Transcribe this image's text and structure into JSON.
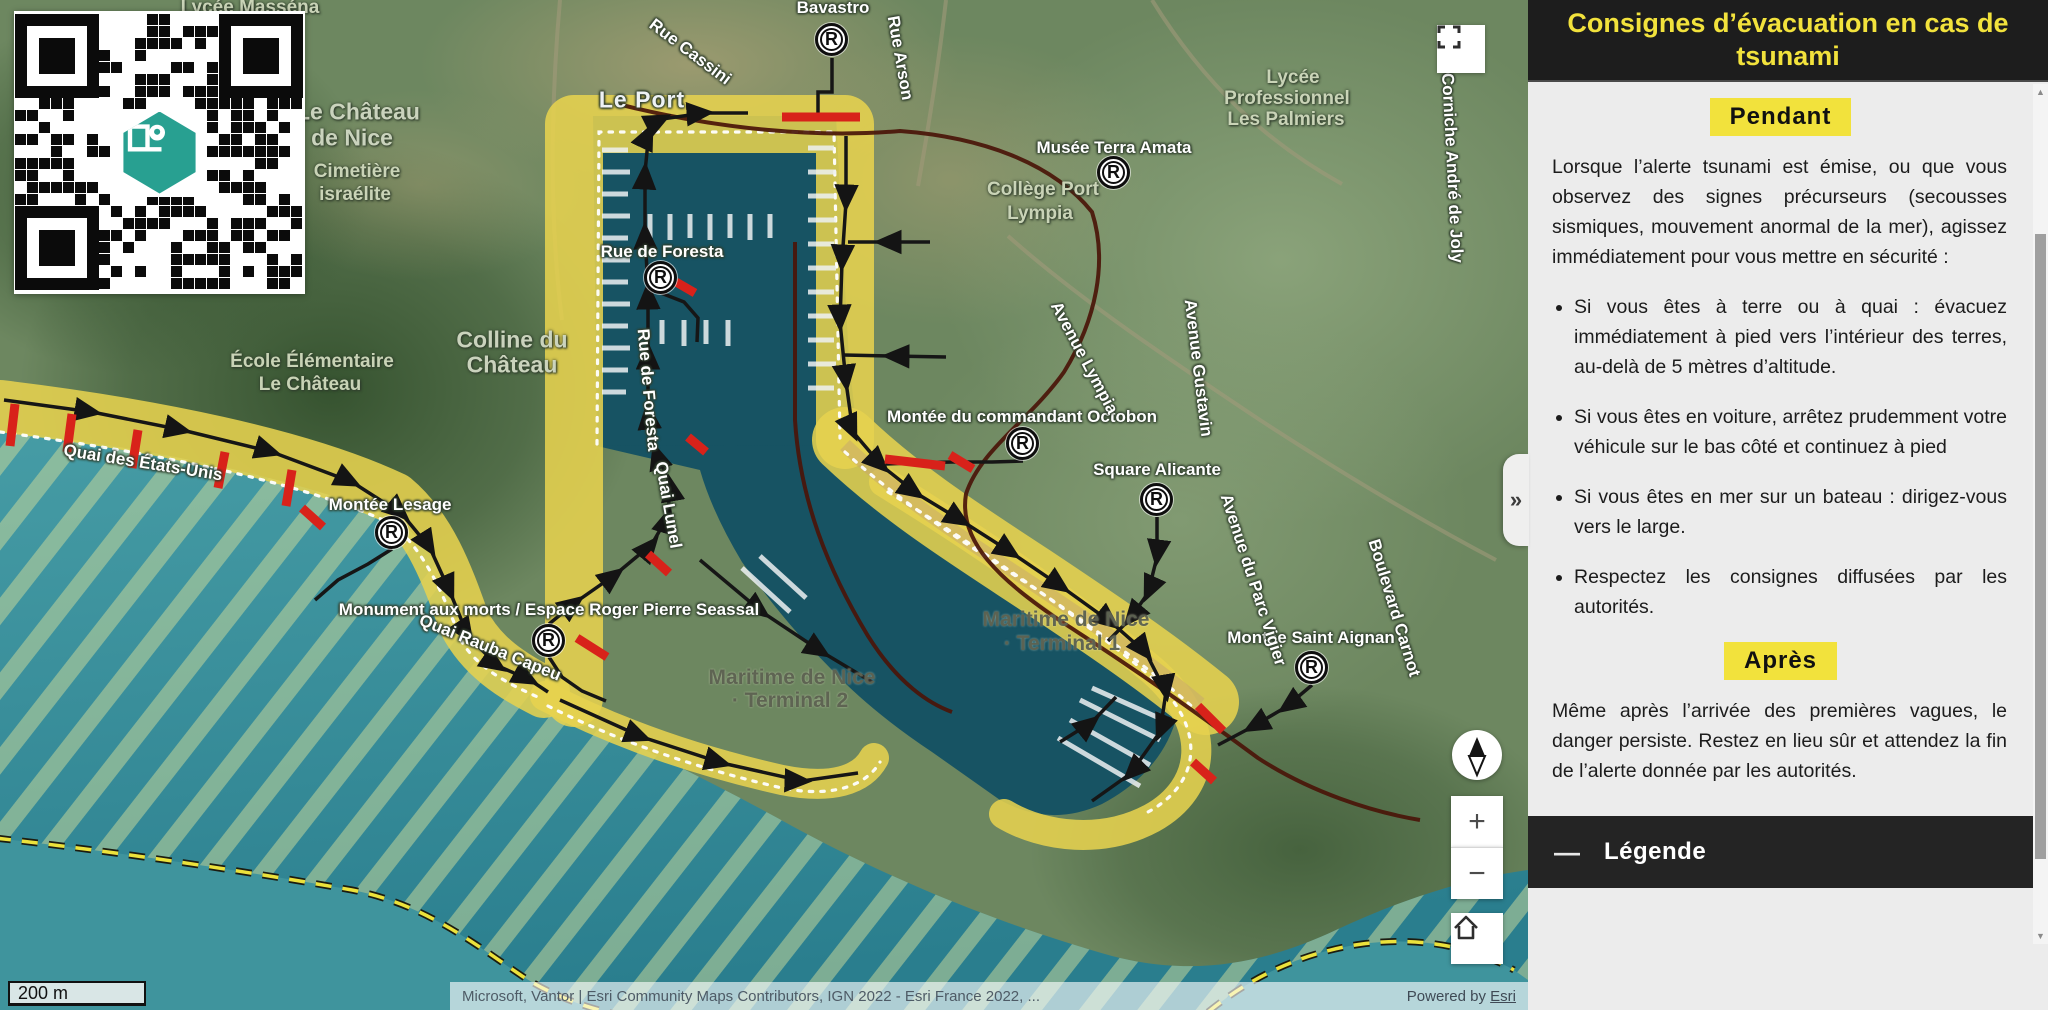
{
  "sidebar": {
    "title": "Consignes d’évacuation en cas de tsunami",
    "collapse_glyph": "»",
    "pendant": {
      "badge": "Pendant",
      "intro": "Lorsque l’alerte tsunami est émise, ou que vous observez des signes précurseurs (secousses sismiques, mouvement anormal de la mer), agissez immédiatement pour vous mettre en sécurité :",
      "bullets": [
        "Si vous êtes à terre ou à quai : évacuez immédiatement à pied vers l’intérieur des terres, au-delà de 5 mètres d’altitude.",
        "Si vous êtes en voiture, arrêtez prudemment votre véhicule sur le bas côté et continuez à pied",
        "Si vous êtes en mer sur un bateau : dirigez-vous vers le large.",
        "Respectez les consignes diffusées par les autorités."
      ]
    },
    "apres": {
      "badge": "Après",
      "text": "Même après l’arrivée des premières vagues, le danger persiste. Restez en lieu sûr et attendez la fin de l’alerte donnée par les autorités."
    },
    "legend": {
      "label": "Légende",
      "collapse_glyph": "—"
    }
  },
  "controls": {
    "zoom_in": "+",
    "zoom_out": "−",
    "fullscreen_icon": "fullscreen",
    "compass_icon": "compass-north",
    "home_icon": "home"
  },
  "map": {
    "scale_label": "200 m",
    "attribution": {
      "sources": "Microsoft, Vantor | Esri Community Maps Contributors, IGN 2022 - Esri France 2022, ...",
      "powered_by": "Powered by",
      "powered_by_link": "Esri"
    },
    "refuge_glyph": "R",
    "refuge_points": [
      {
        "x": 832,
        "y": 40
      },
      {
        "x": 661,
        "y": 278
      },
      {
        "x": 1114,
        "y": 173
      },
      {
        "x": 392,
        "y": 533
      },
      {
        "x": 549,
        "y": 641
      },
      {
        "x": 1023,
        "y": 444
      },
      {
        "x": 1157,
        "y": 500
      },
      {
        "x": 1312,
        "y": 668
      }
    ],
    "labels": [
      {
        "text": "Lycée Masséna",
        "x": 250,
        "y": 8,
        "rot": 0,
        "cls": "poi"
      },
      {
        "text": "Bavastro",
        "x": 833,
        "y": 8,
        "rot": 0,
        "cls": ""
      },
      {
        "text": "Rue Cassini",
        "x": 690,
        "y": 52,
        "rot": 37,
        "cls": ""
      },
      {
        "text": "Rue Arson",
        "x": 900,
        "y": 58,
        "rot": 80,
        "cls": ""
      },
      {
        "text": "Le Port",
        "x": 642,
        "y": 100,
        "rot": 0,
        "cls": "st-lg"
      },
      {
        "text": "Le Château",
        "x": 358,
        "y": 112,
        "rot": 0,
        "cls": "poi-l"
      },
      {
        "text": "de Nice",
        "x": 352,
        "y": 138,
        "rot": 0,
        "cls": "poi-l"
      },
      {
        "text": "Cimetière",
        "x": 357,
        "y": 172,
        "rot": 0,
        "cls": "poi"
      },
      {
        "text": "israélite",
        "x": 355,
        "y": 195,
        "rot": 0,
        "cls": "poi"
      },
      {
        "text": "Musée Terra Amata",
        "x": 1114,
        "y": 148,
        "rot": 0,
        "cls": ""
      },
      {
        "text": "Collège Port",
        "x": 1043,
        "y": 190,
        "rot": 0,
        "cls": "poi"
      },
      {
        "text": "Lympia",
        "x": 1040,
        "y": 214,
        "rot": 0,
        "cls": "poi"
      },
      {
        "text": "Lycée",
        "x": 1293,
        "y": 78,
        "rot": 0,
        "cls": "poi"
      },
      {
        "text": "Professionnel",
        "x": 1287,
        "y": 99,
        "rot": 0,
        "cls": "poi"
      },
      {
        "text": "Les Palmiers",
        "x": 1286,
        "y": 120,
        "rot": 0,
        "cls": "poi"
      },
      {
        "text": "Rue de Foresta",
        "x": 662,
        "y": 252,
        "rot": 0,
        "cls": ""
      },
      {
        "text": "Rue de Foresta",
        "x": 648,
        "y": 390,
        "rot": 85,
        "cls": ""
      },
      {
        "text": "Colline du",
        "x": 512,
        "y": 340,
        "rot": 0,
        "cls": "poi-l"
      },
      {
        "text": "Château",
        "x": 512,
        "y": 365,
        "rot": 0,
        "cls": "poi-l"
      },
      {
        "text": "École Élémentaire",
        "x": 312,
        "y": 362,
        "rot": 0,
        "cls": "poi"
      },
      {
        "text": "Le Château",
        "x": 310,
        "y": 385,
        "rot": 0,
        "cls": "poi"
      },
      {
        "text": "Quai des États-Unis",
        "x": 143,
        "y": 463,
        "rot": 9,
        "cls": ""
      },
      {
        "text": "Montée Lesage",
        "x": 390,
        "y": 505,
        "rot": 0,
        "cls": ""
      },
      {
        "text": "Monument aux morts / Espace Roger Pierre Seassal",
        "x": 549,
        "y": 610,
        "rot": 0,
        "cls": ""
      },
      {
        "text": "Quai Rauba Capeu",
        "x": 490,
        "y": 648,
        "rot": 22,
        "cls": ""
      },
      {
        "text": "Quai Lunel",
        "x": 668,
        "y": 505,
        "rot": 80,
        "cls": ""
      },
      {
        "text": "Montée du commandant Octobon",
        "x": 1022,
        "y": 417,
        "rot": 0,
        "cls": ""
      },
      {
        "text": "Avenue Lympia",
        "x": 1084,
        "y": 358,
        "rot": 62,
        "cls": ""
      },
      {
        "text": "Avenue Gustavin",
        "x": 1198,
        "y": 368,
        "rot": 83,
        "cls": ""
      },
      {
        "text": "Square Alicante",
        "x": 1157,
        "y": 470,
        "rot": 0,
        "cls": ""
      },
      {
        "text": "Montée Saint Aignan",
        "x": 1311,
        "y": 638,
        "rot": 0,
        "cls": ""
      },
      {
        "text": "Avenue du Parc Vigier",
        "x": 1253,
        "y": 580,
        "rot": 72,
        "cls": ""
      },
      {
        "text": "Boulevard Carnot",
        "x": 1394,
        "y": 608,
        "rot": 73,
        "cls": ""
      },
      {
        "text": "Corniche André de Joly",
        "x": 1452,
        "y": 168,
        "rot": 87,
        "cls": ""
      },
      {
        "text": "Maritime de Nice",
        "x": 1066,
        "y": 620,
        "rot": 0,
        "cls": "poi-dk"
      },
      {
        "text": "· Terminal 1",
        "x": 1062,
        "y": 644,
        "rot": 0,
        "cls": "poi-dk"
      },
      {
        "text": "Maritime de Nice",
        "x": 792,
        "y": 678,
        "rot": 0,
        "cls": "poi-dk"
      },
      {
        "text": "· Terminal 2",
        "x": 790,
        "y": 701,
        "rot": 0,
        "cls": "poi-dk"
      }
    ]
  },
  "colors": {
    "accent_yellow": "#F2E23C",
    "header_black": "#1D1D1D",
    "sidebar_bg": "#ECECEC",
    "flood_zone_yellow": "#E6D24F",
    "sea_teal": "#2F828F",
    "port_teal": "#175363",
    "hatch_stripe": "#C9D999",
    "route_black": "#161616",
    "route_red": "#D8221A"
  }
}
